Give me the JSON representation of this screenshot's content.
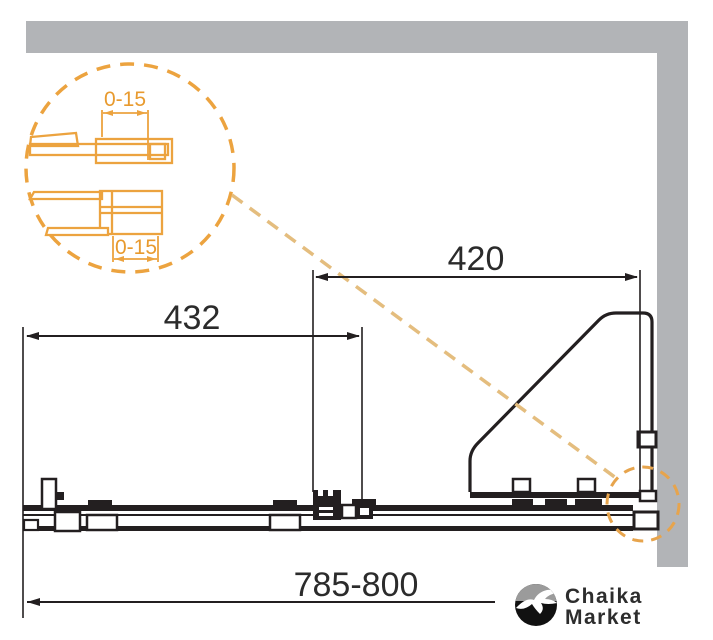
{
  "diagram": {
    "title_semantic": "shower-door-track-top-view",
    "dimensions": {
      "top": "420",
      "middle": "432",
      "bottom": "785-800"
    },
    "detail_callout": {
      "top_adjustment_label": "0-15",
      "bottom_adjustment_label": "0-15"
    },
    "colors": {
      "wall_gray": "#b2b4b7",
      "line_black": "#231f20",
      "accent_orange": "#eca33f",
      "leader_tan": "#e4bd7e",
      "detail_zone_orange": "#e7a44c"
    }
  },
  "watermark": {
    "brand_line1": "Chaika",
    "brand_line2": "Market"
  }
}
